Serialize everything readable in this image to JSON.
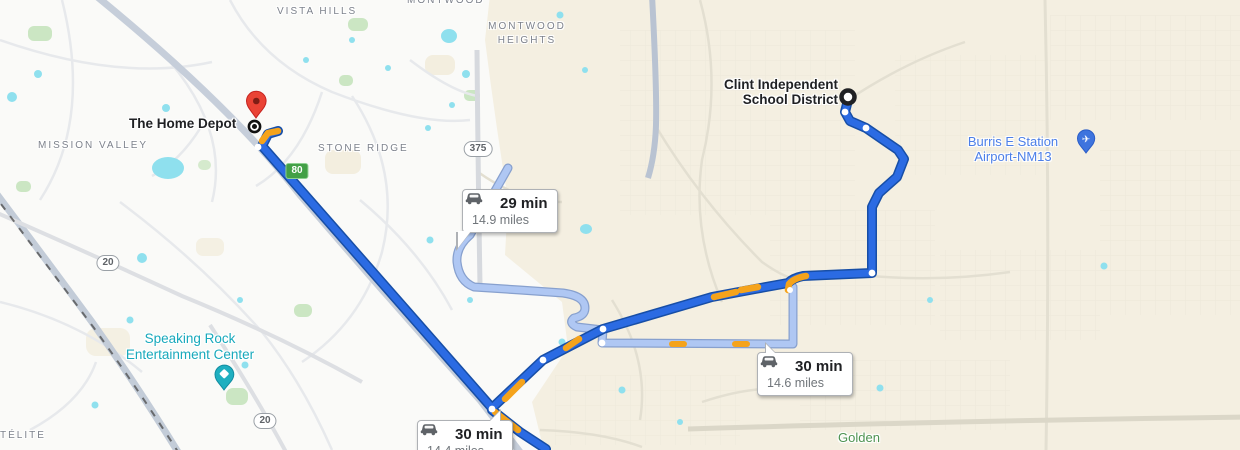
{
  "map_labels": {
    "vista_hills": "VISTA HILLS",
    "montwood": "MONTWOOD",
    "montwood_heights_line1": "MONTWOOD",
    "montwood_heights_line2": "HEIGHTS",
    "mission_valley": "MISSION VALLEY",
    "stone_ridge": "STONE RIDGE",
    "satelite_partial": "TÉLITE",
    "golden": "Golden"
  },
  "places": {
    "home_depot": {
      "name": "The Home Depot"
    },
    "clint_isd": {
      "line1": "Clint Independent",
      "line2": "School District"
    },
    "airport": {
      "line1": "Burris E Station",
      "line2": "Airport-NM13"
    },
    "speaking_rock": {
      "line1": "Speaking Rock",
      "line2": "Entertainment Center"
    }
  },
  "route_badges": [
    {
      "time": "29 min",
      "distance": "14.9 miles"
    },
    {
      "time": "30 min",
      "distance": "14.6 miles"
    },
    {
      "time": "30 min",
      "distance": "14.4 miles"
    }
  ],
  "road_shields": [
    {
      "label": "375",
      "style": "oval"
    },
    {
      "label": "20",
      "style": "oval"
    },
    {
      "label": "20",
      "style": "oval"
    },
    {
      "label": "80",
      "style": "green"
    }
  ],
  "colors": {
    "route_primary": "#2B6BE3",
    "route_primary_casing": "#174EA6",
    "route_alternate": "#AFC7F3",
    "route_alternate_casing": "#87A0CE",
    "traffic_orange": "#F5A31B",
    "destination_pin_red": "#EA4335",
    "airport_label_blue": "#4C7FE8",
    "attraction_label_teal": "#18A9BC",
    "area_label_gray": "#7D828C",
    "park_label_green": "#4E9351",
    "urban_background": "#FAFAF8",
    "rural_background": "#F4EFE1",
    "water": "#8FE0EE",
    "park_green": "#CBE6C3"
  }
}
